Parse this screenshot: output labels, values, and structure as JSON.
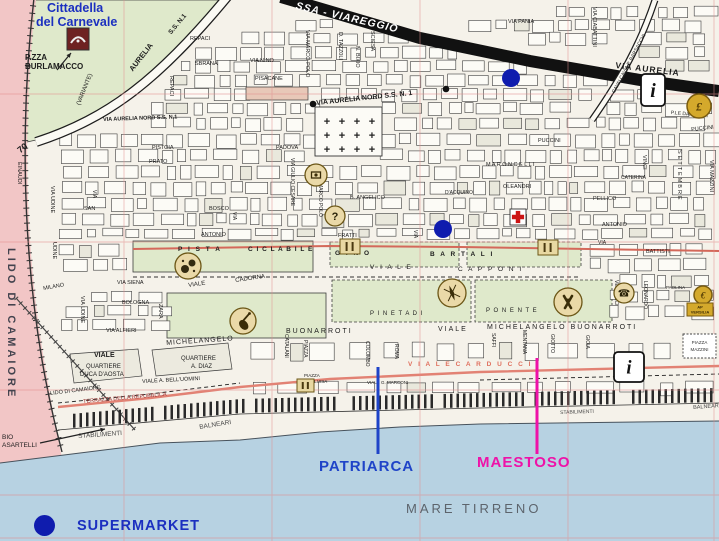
{
  "areas": {
    "cittadella_line1": "Cittadella",
    "cittadella_line2": "del Carnevale"
  },
  "legend": {
    "supermarket": "SUPERMARKET"
  },
  "callouts": {
    "patriarca": {
      "label": "PATRIARCA",
      "color": "#1f44c8",
      "line": {
        "x": 378,
        "y1": 367,
        "y2": 454
      }
    },
    "maestoso": {
      "label": "MAESTOSO",
      "color": "#ee12a8",
      "line": {
        "x": 537,
        "y1": 358,
        "y2": 454
      }
    }
  },
  "sea": {
    "name": "MARE TIRRENO"
  },
  "colors": {
    "blue": "#1b2fc0",
    "dot": "#0f1cae",
    "magenta": "#ee12a8",
    "carducci": "#e0705e",
    "maroon": "#9c3030",
    "gray": "#5d646c",
    "gray2": "#474747",
    "slate": "#43434e",
    "white": "#ffffff",
    "green": "#dfe9cb",
    "sea": "#b7d2e2",
    "pink": "#f2c6c6",
    "redline": "#e28274"
  },
  "labels": [
    {
      "t": "P.ZZA",
      "x": 25,
      "y": 54,
      "s": 8,
      "b": 1,
      "n": "pzza-burlamacco"
    },
    {
      "t": "BURLAMACCO",
      "x": 25,
      "y": 63,
      "s": 8,
      "b": 1
    },
    {
      "t": "S.S. N.1",
      "x": 168,
      "y": 32,
      "s": 6.5,
      "r": -50,
      "b": 1
    },
    {
      "t": "AURELIA",
      "x": 128,
      "y": 68,
      "s": 7.5,
      "r": -52,
      "b": 1
    },
    {
      "t": "(VARIANTE)",
      "x": 76,
      "y": 104,
      "s": 6,
      "r": -68
    },
    {
      "t": "SSA - VIAREGGIO",
      "x": 297,
      "y": 1,
      "s": 10.5,
      "r": 13,
      "b": 1,
      "i": 1,
      "c": "white",
      "ls": 1,
      "n": "railway-massa-viareggio"
    },
    {
      "t": "VIA  AURELIA",
      "x": 616,
      "y": 61,
      "s": 8.5,
      "r": 7,
      "b": 1,
      "ls": 1
    },
    {
      "t": "VIA AURELIA NORD S.S. N. 1",
      "x": 316,
      "y": 100,
      "s": 7,
      "r": -6,
      "b": 1
    },
    {
      "t": "VIA AURELIA NORD S.S. N.1",
      "x": 103,
      "y": 118,
      "s": 5.5,
      "r": -2,
      "b": 1
    },
    {
      "t": "REPACI",
      "x": 190,
      "y": 37,
      "s": 5.5
    },
    {
      "t": "SBRANA",
      "x": 195,
      "y": 62,
      "s": 5.5
    },
    {
      "t": "REPACI",
      "x": 173,
      "y": 76,
      "s": 5.5,
      "v": 1
    },
    {
      "t": "VIA NINO",
      "x": 250,
      "y": 59,
      "s": 5.5
    },
    {
      "t": "PISACANE",
      "x": 255,
      "y": 77,
      "s": 5.5
    },
    {
      "t": "VIA MARCO POLO",
      "x": 309,
      "y": 30,
      "s": 5.5,
      "v": 1
    },
    {
      "t": "D. TAZZ0LI",
      "x": 342,
      "y": 32,
      "s": 5.5,
      "v": 1
    },
    {
      "t": "N. BIXIO",
      "x": 359,
      "y": 46,
      "s": 5.5,
      "v": 1
    },
    {
      "t": "SCIESA",
      "x": 374,
      "y": 31,
      "s": 5.5,
      "v": 1
    },
    {
      "t": "VIA PANIA",
      "x": 508,
      "y": 20,
      "s": 5.5
    },
    {
      "t": "VIA CIABATTINI",
      "x": 596,
      "y": 7,
      "s": 5.5,
      "v": 1
    },
    {
      "t": "CAVALCAVIA P. BARSACCHI",
      "x": 612,
      "y": 92,
      "s": 5,
      "r": -62
    },
    {
      "t": "P.LE DANTE ALI",
      "x": 671,
      "y": 111,
      "s": 5,
      "r": 5
    },
    {
      "t": "PUCCINI",
      "x": 538,
      "y": 139,
      "s": 5.5
    },
    {
      "t": "PUCCINI",
      "x": 691,
      "y": 128,
      "s": 5.5,
      "r": -6
    },
    {
      "t": "PISTOIA",
      "x": 152,
      "y": 146,
      "s": 5.5
    },
    {
      "t": "PRATO",
      "x": 149,
      "y": 160,
      "s": 5.5
    },
    {
      "t": "PADOVA",
      "x": 276,
      "y": 146,
      "s": 5.5
    },
    {
      "t": "VIA GIULIO CESARE",
      "x": 294,
      "y": 158,
      "s": 5,
      "v": 1
    },
    {
      "t": "MARCO POLO",
      "x": 322,
      "y": 183,
      "s": 5,
      "v": 1
    },
    {
      "t": "M A R O N C E L L I",
      "x": 486,
      "y": 163,
      "s": 5.5
    },
    {
      "t": "OLEANDRI",
      "x": 503,
      "y": 185,
      "s": 5.5
    },
    {
      "t": "VINCI",
      "x": 646,
      "y": 155,
      "s": 5.5,
      "v": 1
    },
    {
      "t": "CATERINA",
      "x": 621,
      "y": 176,
      "s": 5
    },
    {
      "t": "SETTEMBRE",
      "x": 681,
      "y": 150,
      "s": 5.5,
      "v": 1,
      "ls": 2
    },
    {
      "t": "VIA MAZZINI",
      "x": 713,
      "y": 160,
      "s": 5.5,
      "v": 1
    },
    {
      "t": "PELLICO",
      "x": 593,
      "y": 197,
      "s": 5.5
    },
    {
      "t": "B. ANGELICO",
      "x": 350,
      "y": 196,
      "s": 5.5
    },
    {
      "t": "D'ACQUINO",
      "x": 445,
      "y": 191,
      "s": 5
    },
    {
      "t": "VIA UDINE",
      "x": 54,
      "y": 186,
      "s": 5.5,
      "v": 1
    },
    {
      "t": "UDINE",
      "x": 56,
      "y": 242,
      "s": 5.5,
      "v": 1
    },
    {
      "t": "VIA UDINE",
      "x": 84,
      "y": 296,
      "s": 5.5,
      "v": 1
    },
    {
      "t": "EINAUDI",
      "x": 21,
      "y": 162,
      "s": 5.5,
      "v": 1
    },
    {
      "t": "SAN",
      "x": 84,
      "y": 207,
      "s": 5.5
    },
    {
      "t": "BOSCO",
      "x": 209,
      "y": 207,
      "s": 5.5
    },
    {
      "t": "ANTONIO",
      "x": 201,
      "y": 233,
      "s": 5.5
    },
    {
      "t": "ANTONIO",
      "x": 602,
      "y": 223,
      "s": 5.5
    },
    {
      "t": "FRATTI",
      "x": 338,
      "y": 234,
      "s": 5.5
    },
    {
      "t": "BATTISTI",
      "x": 646,
      "y": 250,
      "s": 5.5
    },
    {
      "t": "VIA SIENA",
      "x": 117,
      "y": 281,
      "s": 5.5
    },
    {
      "t": "BOLOGNA",
      "x": 122,
      "y": 301,
      "s": 5.5
    },
    {
      "t": "MILANO",
      "x": 43,
      "y": 287,
      "s": 5.5,
      "r": -10
    },
    {
      "t": "ZARA",
      "x": 162,
      "y": 304,
      "s": 5.5,
      "v": 1
    },
    {
      "t": "VIA ALFIERI",
      "x": 106,
      "y": 329,
      "s": 5.5
    },
    {
      "t": "P I S T A",
      "x": 178,
      "y": 247,
      "s": 6.5,
      "b": 1,
      "ls": 2
    },
    {
      "t": "C I C L A B I L E",
      "x": 248,
      "y": 247,
      "s": 6.5,
      "b": 1,
      "ls": 1
    },
    {
      "t": "VIALE",
      "x": 188,
      "y": 283,
      "s": 6,
      "r": -8
    },
    {
      "t": "CADORNA",
      "x": 235,
      "y": 278,
      "s": 6,
      "r": -8
    },
    {
      "t": "G I N O",
      "x": 335,
      "y": 251,
      "s": 6.5,
      "b": 1,
      "ls": 2
    },
    {
      "t": "B A R T A L I",
      "x": 430,
      "y": 252,
      "s": 6.5,
      "b": 1,
      "ls": 2
    },
    {
      "t": "V I A L E",
      "x": 370,
      "y": 265,
      "s": 6.5,
      "ls": 2
    },
    {
      "t": "C A P P O N I",
      "x": 458,
      "y": 267,
      "s": 6.5,
      "ls": 2
    },
    {
      "t": "P I N E T A   D I",
      "x": 370,
      "y": 311,
      "s": 6,
      "ls": 1
    },
    {
      "t": "P O N E N T E",
      "x": 486,
      "y": 308,
      "s": 6,
      "ls": 1
    },
    {
      "t": "BUONARROTI",
      "x": 286,
      "y": 328,
      "s": 7,
      "ls": 2
    },
    {
      "t": "VIALE",
      "x": 438,
      "y": 326,
      "s": 7,
      "ls": 2
    },
    {
      "t": "MICHELANGELO  BUONARROTI",
      "x": 487,
      "y": 324,
      "s": 7,
      "ls": 2
    },
    {
      "t": "VIALE",
      "x": 94,
      "y": 352,
      "s": 7,
      "b": 1
    },
    {
      "t": "MICHELANGELO",
      "x": 166,
      "y": 340,
      "s": 7,
      "r": -4,
      "ls": 1
    },
    {
      "t": "QUARTIERE",
      "x": 86,
      "y": 364,
      "s": 6
    },
    {
      "t": "DUCA D'AOSTA",
      "x": 80,
      "y": 372,
      "s": 6
    },
    {
      "t": "QUARTIERE",
      "x": 181,
      "y": 356,
      "s": 6
    },
    {
      "t": "A. DIAZ",
      "x": 191,
      "y": 364,
      "s": 6
    },
    {
      "t": "CATALANI",
      "x": 288,
      "y": 334,
      "s": 5,
      "v": 1
    },
    {
      "t": "PIAZZA",
      "x": 307,
      "y": 340,
      "s": 5,
      "v": 1
    },
    {
      "t": "COLOMBO",
      "x": 369,
      "y": 341,
      "s": 5,
      "v": 1
    },
    {
      "t": "ROMA",
      "x": 398,
      "y": 344,
      "s": 5,
      "v": 1
    },
    {
      "t": "SAFFI",
      "x": 495,
      "y": 333,
      "s": 5,
      "v": 1
    },
    {
      "t": "MENTANA",
      "x": 526,
      "y": 330,
      "s": 5,
      "v": 1
    },
    {
      "t": "GIOTTO",
      "x": 554,
      "y": 334,
      "s": 5,
      "v": 1
    },
    {
      "t": "GIOIA",
      "x": 589,
      "y": 335,
      "s": 5,
      "v": 1
    },
    {
      "t": "VESPUCCI",
      "x": 618,
      "y": 280,
      "s": 5,
      "v": 1
    },
    {
      "t": "LEONARDO",
      "x": 647,
      "y": 281,
      "s": 5,
      "v": 1
    },
    {
      "t": "V I A L E   C A R D U C C I",
      "x": 408,
      "y": 362,
      "s": 6.5,
      "ls": 2,
      "b": 1,
      "c": "carducci"
    },
    {
      "t": "PIAZZA",
      "x": 304,
      "y": 374,
      "s": 4.5
    },
    {
      "t": "MARIA LUISA",
      "x": 299,
      "y": 380,
      "s": 4.5
    },
    {
      "t": "VIALE G. MARCONI",
      "x": 367,
      "y": 381,
      "s": 4.5
    },
    {
      "t": "VIALE A. BELL'UOMINI",
      "x": 142,
      "y": 380,
      "s": 5.5,
      "r": -3
    },
    {
      "t": "LIDO DI CAMAIORE",
      "x": 50,
      "y": 392,
      "s": 5.5,
      "r": -7
    },
    {
      "t": "TERRAZZA DELLA REPUBBLICA",
      "x": 83,
      "y": 400,
      "s": 5.5,
      "r": -5,
      "c": "maroon"
    },
    {
      "t": "STABILIMENTI",
      "x": 78,
      "y": 434,
      "s": 6.5,
      "r": -4,
      "c": "gray2"
    },
    {
      "t": "BALNEARI",
      "x": 199,
      "y": 425,
      "s": 6.5,
      "r": -9,
      "c": "gray2"
    },
    {
      "t": "STABILIMENTI",
      "x": 560,
      "y": 411,
      "s": 5,
      "r": -2,
      "c": "gray2"
    },
    {
      "t": "BALNEARI",
      "x": 693,
      "y": 406,
      "s": 5.5,
      "r": -4,
      "c": "gray2"
    },
    {
      "t": "BIO",
      "x": 2,
      "y": 435,
      "s": 6.5
    },
    {
      "t": "ASARTELLI",
      "x": 2,
      "y": 443,
      "s": 6.5
    },
    {
      "t": "LIDO DI CAMAIORE",
      "x": 16,
      "y": 248,
      "s": 11,
      "v": 1,
      "b": 1,
      "ls": 3,
      "c": "slate",
      "n": "lido-di-camaiore-area"
    },
    {
      "t": "70",
      "x": 16,
      "y": 148,
      "s": 9,
      "r": -38,
      "b": 1
    },
    {
      "t": "PAOLINA",
      "x": 666,
      "y": 286,
      "s": 4.5
    },
    {
      "t": "VIA",
      "x": 96,
      "y": 190,
      "s": 5,
      "v": 1
    },
    {
      "t": "VIA",
      "x": 236,
      "y": 212,
      "s": 5,
      "v": 1
    },
    {
      "t": "VIA",
      "x": 417,
      "y": 230,
      "s": 5,
      "v": 1
    },
    {
      "t": "VIA",
      "x": 598,
      "y": 241,
      "s": 5
    }
  ],
  "icons": [
    {
      "type": "mask",
      "x": 67,
      "y": 28,
      "s": 22,
      "n": "carnevale-mask-icon"
    },
    {
      "type": "arrow",
      "x1": 57,
      "y1": 70,
      "x2": 71,
      "y2": 53,
      "n": "burlamacco-arrow"
    },
    {
      "type": "arrow",
      "x1": 40,
      "y1": 443,
      "x2": 105,
      "y2": 429,
      "n": "casartelli-arrow"
    },
    {
      "type": "blackdot",
      "x": 313,
      "y": 104,
      "r": 3.3,
      "n": "road-dot"
    },
    {
      "type": "blackdot",
      "x": 446,
      "y": 89,
      "r": 3.3,
      "n": "road-dot-2"
    },
    {
      "type": "cemetery",
      "x": 315,
      "y": 107,
      "w": 67,
      "h": 49,
      "n": "cemetery-icon"
    },
    {
      "type": "camera",
      "x": 316,
      "y": 175,
      "r": 11,
      "n": "sight-icon"
    },
    {
      "type": "question",
      "x": 335,
      "y": 216,
      "r": 10,
      "n": "help-icon"
    },
    {
      "type": "balls",
      "x": 188,
      "y": 266,
      "r": 13,
      "n": "bocce-icon"
    },
    {
      "type": "guitar",
      "x": 243,
      "y": 321,
      "r": 13,
      "n": "music-icon"
    },
    {
      "type": "compass",
      "x": 452,
      "y": 293,
      "r": 14,
      "n": "compass-icon"
    },
    {
      "type": "paddles",
      "x": 568,
      "y": 302,
      "r": 14,
      "n": "sport-icon"
    },
    {
      "type": "phone",
      "x": 624,
      "y": 293,
      "r": 10,
      "n": "telephone-icon"
    },
    {
      "type": "coin",
      "x": 699,
      "y": 106,
      "r": 12,
      "g": "£",
      "n": "currency-icon"
    },
    {
      "type": "coin",
      "x": 703,
      "y": 295,
      "r": 9,
      "g": "€",
      "n": "currency-icon-2"
    },
    {
      "type": "goldbox",
      "x": 687,
      "y": 303,
      "w": 26,
      "h": 13,
      "t1": "AP",
      "t2": "VERSILIA",
      "n": "ap-versilia-badge"
    },
    {
      "type": "dashedbox",
      "x": 683,
      "y": 334,
      "w": 33,
      "h": 24,
      "t1": "PIAZZA",
      "t2": "MAZZINI",
      "n": "piazza-mazzini-box"
    },
    {
      "type": "redcross",
      "x": 510,
      "y": 209,
      "s": 16,
      "n": "hospital-icon"
    },
    {
      "type": "routebox",
      "x": 340,
      "y": 239,
      "w": 20,
      "h": 15,
      "n": "route-marker"
    },
    {
      "type": "routebox",
      "x": 538,
      "y": 240,
      "w": 20,
      "h": 15,
      "n": "route-marker-2"
    },
    {
      "type": "routebox",
      "x": 297,
      "y": 379,
      "w": 17,
      "h": 13,
      "n": "route-marker-3"
    },
    {
      "type": "info",
      "x": 641,
      "y": 74,
      "w": 24,
      "h": 32,
      "g": "i",
      "n": "tourist-info-icon"
    },
    {
      "type": "info",
      "x": 614,
      "y": 352,
      "w": 30,
      "h": 30,
      "g": "i",
      "n": "tourist-info-icon-2"
    },
    {
      "type": "supermarket",
      "x": 511,
      "y": 78,
      "r": 9,
      "n": "supermarket-marker"
    },
    {
      "type": "supermarket",
      "x": 443,
      "y": 229,
      "r": 9,
      "n": "supermarket-marker-2"
    }
  ]
}
